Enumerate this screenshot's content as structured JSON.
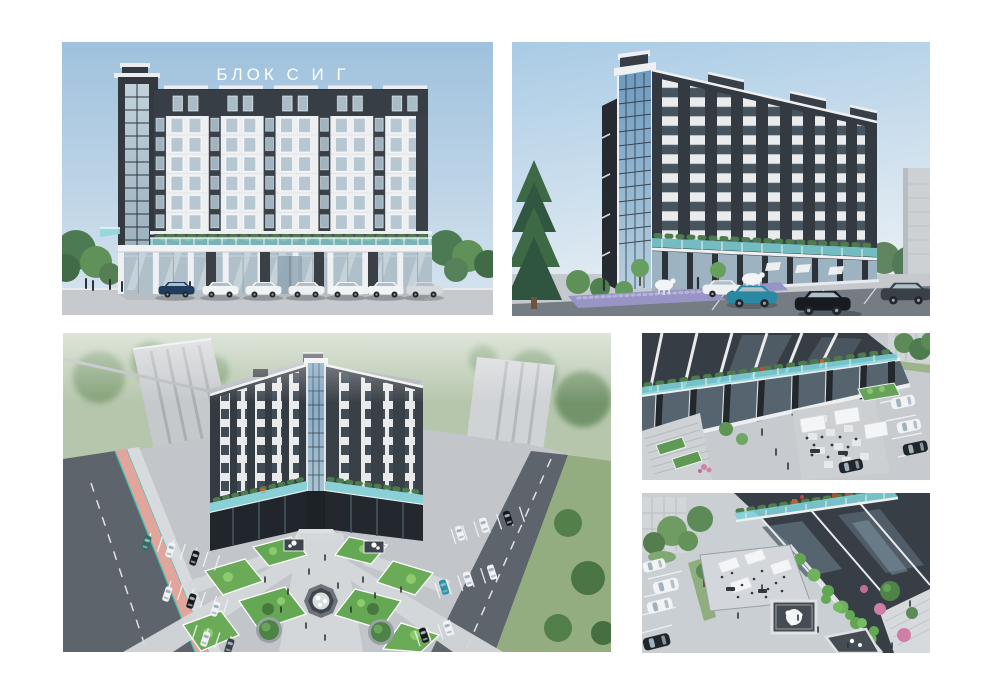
{
  "page": {
    "background": "#ffffff"
  },
  "title": {
    "text": "БЛОК С И Г",
    "color": "#fdfefe"
  },
  "palette": {
    "sky": "#a5c7e2",
    "charcoal": "#363c43",
    "facade_white": "#edeff1",
    "window_glass": "#b4c4cf",
    "terrace_glass": "#7fd3d9",
    "greenery": "#5f9a54",
    "pavement": "#c5c9ce",
    "road": "#5e646c",
    "bike_lane_pink": "#e2a59c",
    "car_teal": "#2a88a2"
  }
}
